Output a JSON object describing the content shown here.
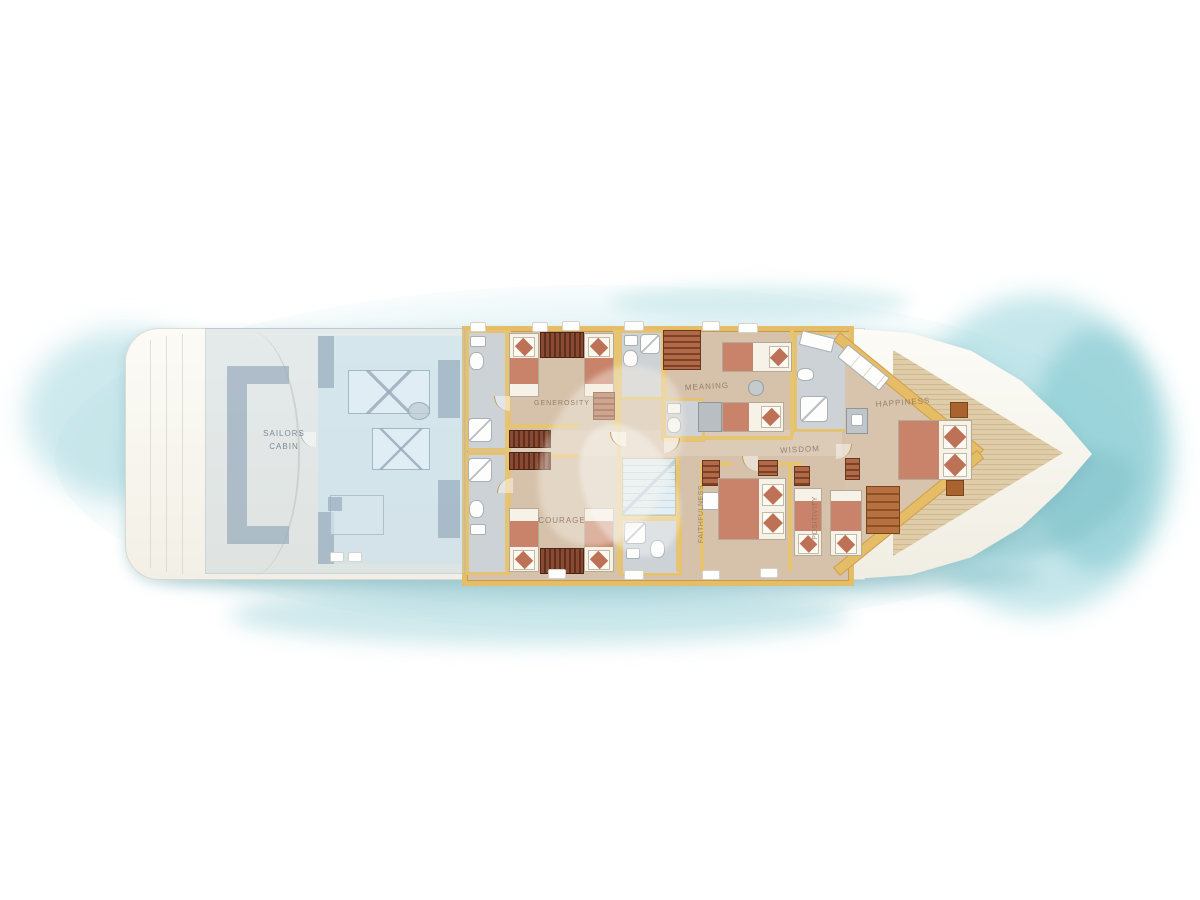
{
  "title": "Yacht lower deck floor plan",
  "plan": {
    "rooms": {
      "sailors_cabin": {
        "line1": "SAILORS",
        "line2": "CABIN"
      },
      "generosity": {
        "label": "GENEROSITY"
      },
      "courage": {
        "label": "COURAGE"
      },
      "meaning": {
        "label": "MEANING"
      },
      "wisdom": {
        "label": "WISDOM"
      },
      "faithfulness": {
        "label": "FAITHFULNESS"
      },
      "positivity": {
        "label": "POSITIVITY"
      },
      "happiness": {
        "label": "HAPPINESS"
      }
    }
  },
  "colors": {
    "sea_teal": "#a9dbe0",
    "hull_white": "#fbfaf4",
    "cabin_wall_gold": "#e4bd66",
    "floor_tan": "#d7c3ac",
    "bathroom_grey": "#cdd2d6",
    "blanket_salmon": "#c8836a",
    "bow_deck_wood": "#dcc9a8",
    "stairs_blue": "#cfe4ed",
    "sailors_overlay_blue": "#bccbd6"
  }
}
